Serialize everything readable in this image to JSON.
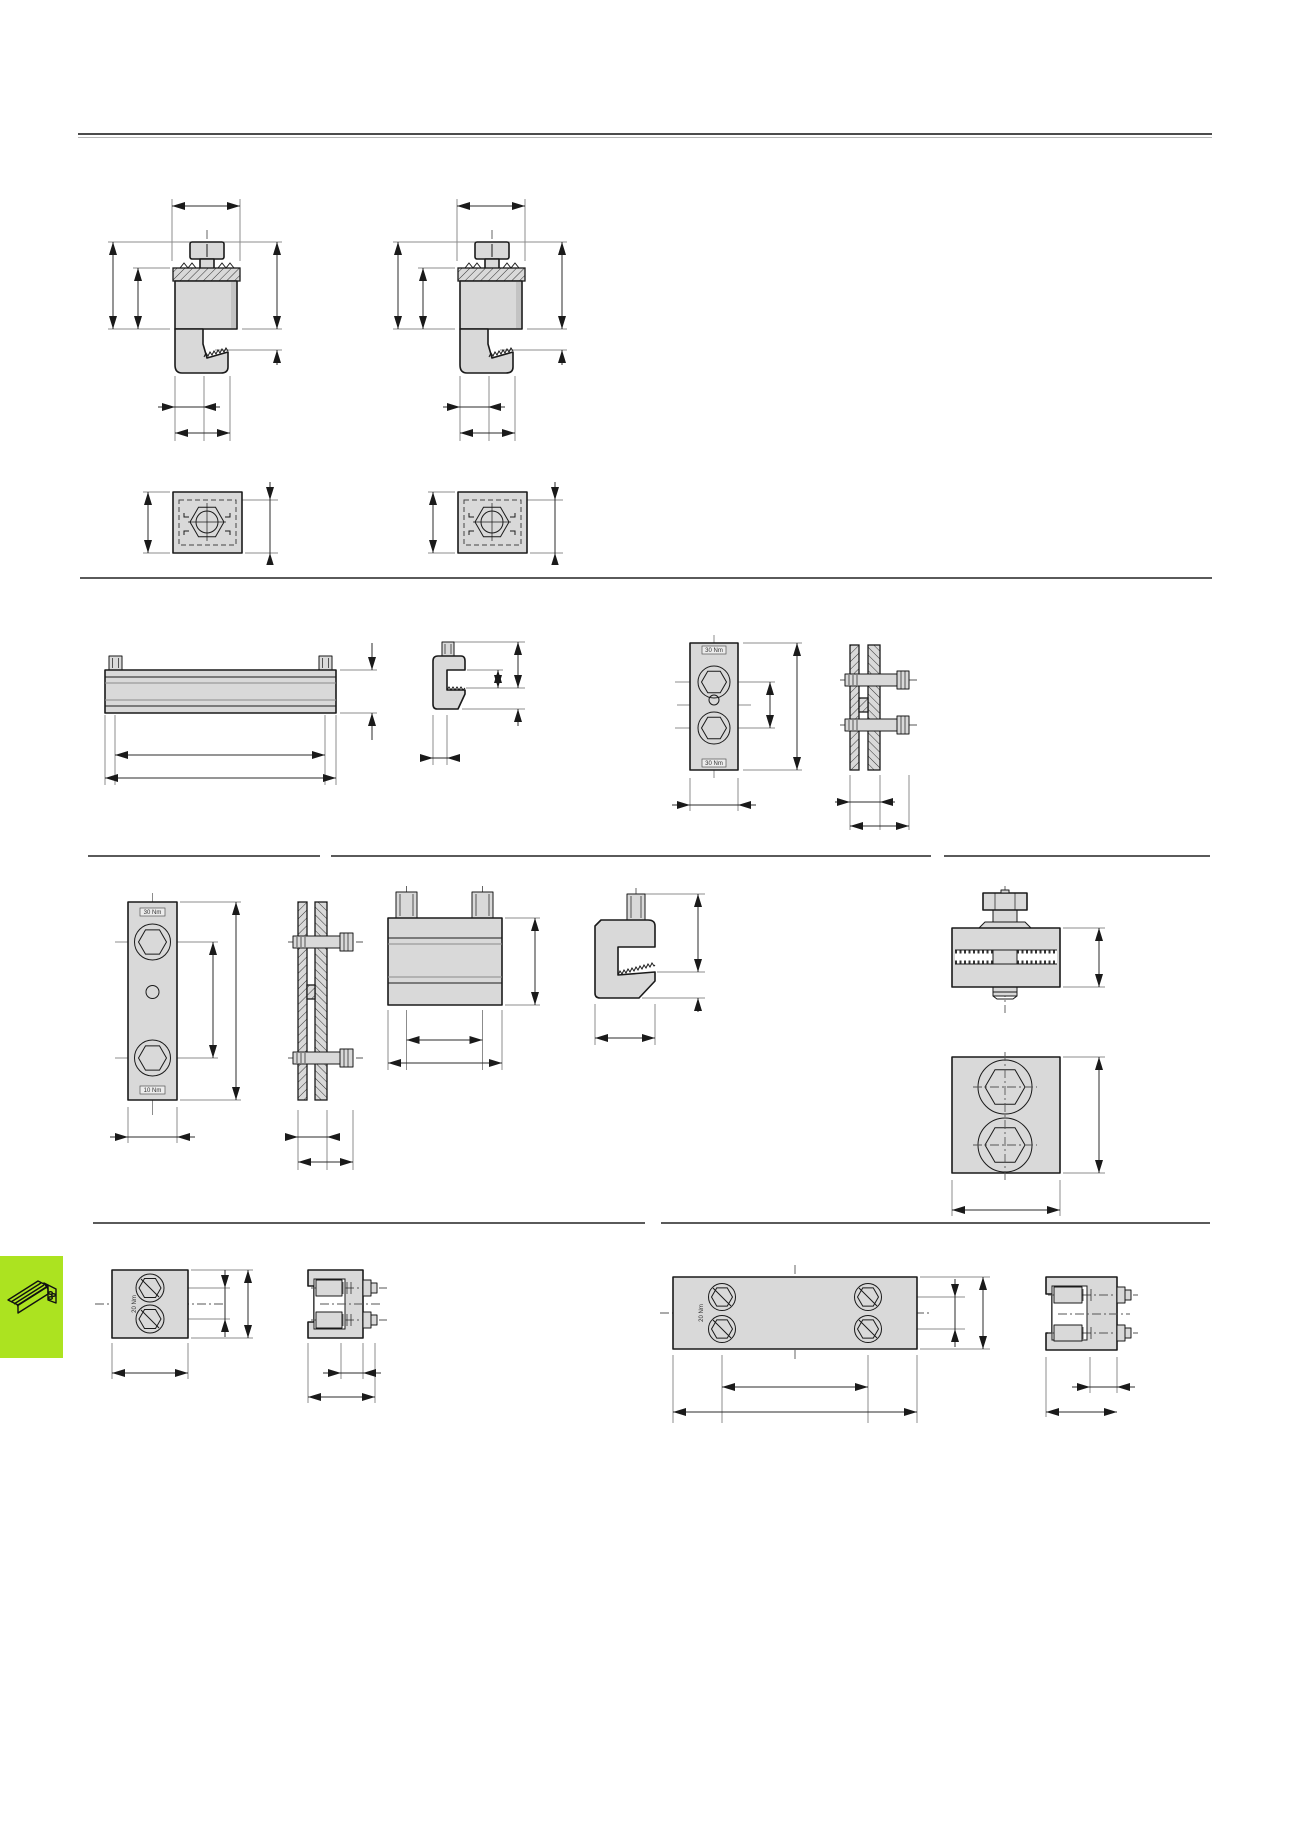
{
  "page": {
    "title": "clamp-profile technical drawings page",
    "background": "#ffffff"
  },
  "colors": {
    "page_bg": "#ffffff",
    "part_fill": "#d9d9d9",
    "part_edge": "#1a1a1a",
    "dim_line": "#2b2b2b",
    "ext_line": "#8c8c8c",
    "rule_dark": "#4b4b4b",
    "rule_light": "#b8b8b8",
    "divider": "#5a5a5a",
    "accent_green": "#ace320"
  },
  "labels": {
    "plate_row2_top": "30 Nm",
    "plate_row2_bottom": "30 Nm",
    "plate_row4_top": "30 Nm",
    "plate_row4_bottom": "10 Nm",
    "block_row5": "20 Nm",
    "plate_row5": "20 Nm"
  },
  "figures": [
    {
      "id": "clamp-side-view-1",
      "view": "side section with screw"
    },
    {
      "id": "clamp-side-view-2",
      "view": "side section with screw"
    },
    {
      "id": "clamp-top-view-1",
      "view": "top view with hex nut"
    },
    {
      "id": "clamp-top-view-2",
      "view": "top view with hex nut"
    },
    {
      "id": "clamping-bar-front",
      "view": "long bar with two studs"
    },
    {
      "id": "clamping-bar-profile",
      "view": "C profile section"
    },
    {
      "id": "connector-plate-row2",
      "view": "front, two hex sockets"
    },
    {
      "id": "connector-section-row2",
      "view": "cross-section with two bolts"
    },
    {
      "id": "connector-plate-row4",
      "view": "front, two hex sockets and pilot hole"
    },
    {
      "id": "connector-section-row4",
      "view": "cross-section with two bolts"
    },
    {
      "id": "clamp-block-front",
      "view": "front with two studs"
    },
    {
      "id": "clamp-block-side",
      "view": "C clamp side with stud"
    },
    {
      "id": "screw-block-side",
      "view": "block with vertical hex screw"
    },
    {
      "id": "screw-block-top",
      "view": "top view two hex sockets"
    },
    {
      "id": "small-block-top-row5",
      "view": "top view two slotted screws"
    },
    {
      "id": "small-block-section-row5",
      "view": "section with two screws"
    },
    {
      "id": "wide-plate-top-row5",
      "view": "top view four slotted screws"
    },
    {
      "id": "wide-plate-section-row5",
      "view": "section with two screws"
    }
  ]
}
